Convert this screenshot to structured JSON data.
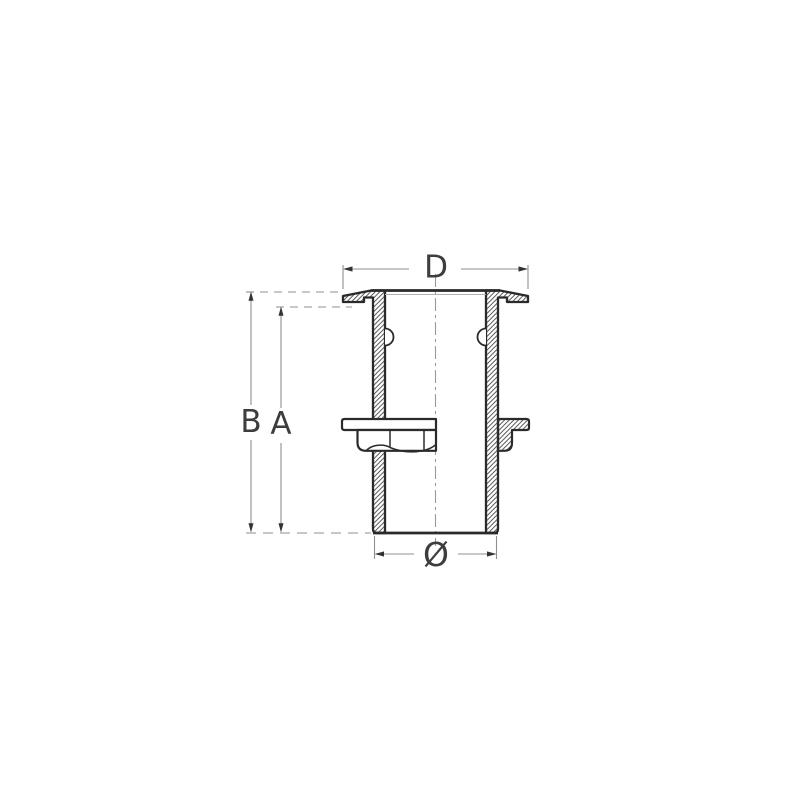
{
  "diagram": {
    "type": "technical-cross-section",
    "subject": "Thru-hull skin fitting with flanged lock nut, half-section view",
    "colors": {
      "outline": "#2a2a2a",
      "hatch": "#3a3a3a",
      "dimension_line": "#8f8f8f",
      "label": "#3d3d3d",
      "background": "#ffffff"
    },
    "dimensions": {
      "flange_width": {
        "label": "D"
      },
      "overall_height": {
        "label": "B"
      },
      "shank_height": {
        "label": "A"
      },
      "thread_diameter": {
        "label": "Ø"
      }
    }
  }
}
